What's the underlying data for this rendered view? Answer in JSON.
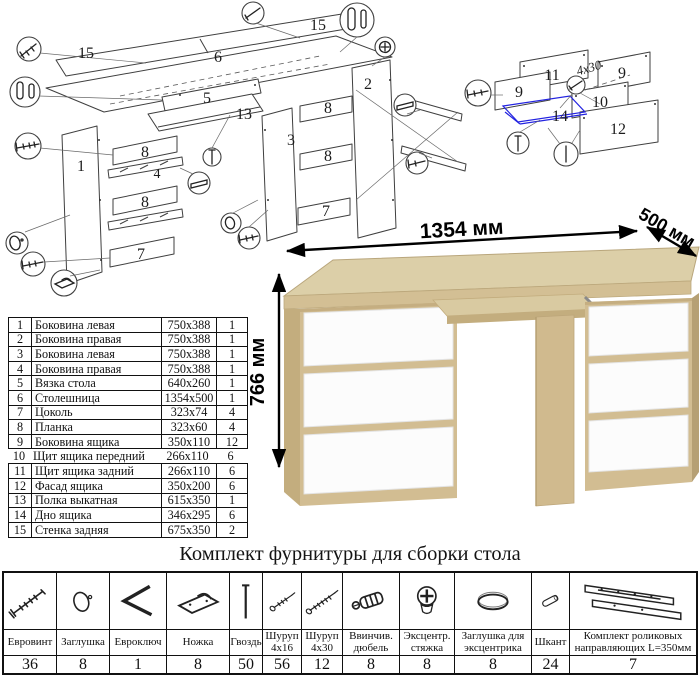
{
  "diagram": {
    "main_labels": [
      "15",
      "6",
      "15",
      "1",
      "8",
      "4",
      "8",
      "7",
      "5",
      "13",
      "3",
      "2",
      "8",
      "8",
      "7"
    ],
    "drawer_labels": [
      "11",
      "9",
      "9",
      "10",
      "12",
      "14"
    ],
    "screw_note": "4x30"
  },
  "desk": {
    "dimensions": {
      "width": "1354 мм",
      "depth": "500 мм",
      "height": "766 мм"
    }
  },
  "parts_table": {
    "rows": [
      {
        "num": "1",
        "name": "Боковина левая",
        "size": "750x388",
        "qty": "1"
      },
      {
        "num": "2",
        "name": "Боковина правая",
        "size": "750x388",
        "qty": "1"
      },
      {
        "num": "3",
        "name": "Боковина левая",
        "size": "750x388",
        "qty": "1"
      },
      {
        "num": "4",
        "name": "Боковина правая",
        "size": "750x388",
        "qty": "1"
      },
      {
        "num": "5",
        "name": "Вязка стола",
        "size": "640x260",
        "qty": "1"
      },
      {
        "num": "6",
        "name": "Столешница",
        "size": "1354x500",
        "qty": "1"
      },
      {
        "num": "7",
        "name": "Цоколь",
        "size": "323x74",
        "qty": "4"
      },
      {
        "num": "8",
        "name": "Планка",
        "size": "323x60",
        "qty": "4"
      },
      {
        "num": "9",
        "name": "Боковина ящика",
        "size": "350x110",
        "qty": "12"
      },
      {
        "num": "10",
        "name": "Щит ящика передний",
        "size": "266x110",
        "qty": "6"
      },
      {
        "num": "11",
        "name": "Щит ящика задний",
        "size": "266x110",
        "qty": "6"
      },
      {
        "num": "12",
        "name": "Фасад ящика",
        "size": "350x200",
        "qty": "6"
      },
      {
        "num": "13",
        "name": "Полка выкатная",
        "size": "615x350",
        "qty": "1"
      },
      {
        "num": "14",
        "name": "Дно ящика",
        "size": "346x295",
        "qty": "6"
      },
      {
        "num": "15",
        "name": "Стенка задняя",
        "size": "675x350",
        "qty": "2"
      }
    ]
  },
  "hardware_section": {
    "title": "Комплект фурнитуры для сборки стола",
    "items": [
      {
        "icon": "euroscrew-icon",
        "name": "Евровинт",
        "qty": "36"
      },
      {
        "icon": "cap-icon",
        "name": "Заглушка",
        "qty": "8"
      },
      {
        "icon": "hexkey-icon",
        "name": "Евроключ",
        "qty": "1"
      },
      {
        "icon": "foot-icon",
        "name": "Ножка",
        "qty": "8"
      },
      {
        "icon": "nail-icon",
        "name": "Гвоздь",
        "qty": "50"
      },
      {
        "icon": "screw-short-icon",
        "name": "Шуруп\n4x16",
        "qty": "56"
      },
      {
        "icon": "screw-long-icon",
        "name": "Шуруп\n4x30",
        "qty": "12"
      },
      {
        "icon": "dowel-screw-icon",
        "name": "Ввинчив.\nдюбель",
        "qty": "8"
      },
      {
        "icon": "cam-lock-icon",
        "name": "Эксцентр.\nстяжка",
        "qty": "8"
      },
      {
        "icon": "cam-cap-icon",
        "name": "Заглушка для\nэксцентрика",
        "qty": "8"
      },
      {
        "icon": "shkant-icon",
        "name": "Шкант",
        "qty": "24"
      },
      {
        "icon": "rails-icon",
        "name": "Комплект роликовых\nнаправляющих L=350мм",
        "qty": "7"
      }
    ]
  },
  "colors": {
    "wood_front": "#d2bd92",
    "wood_top": "#dccfa8",
    "drawer_white": "#fcfcfc",
    "outline": "#3f3f3f",
    "blue_accent": "#2323e0"
  }
}
